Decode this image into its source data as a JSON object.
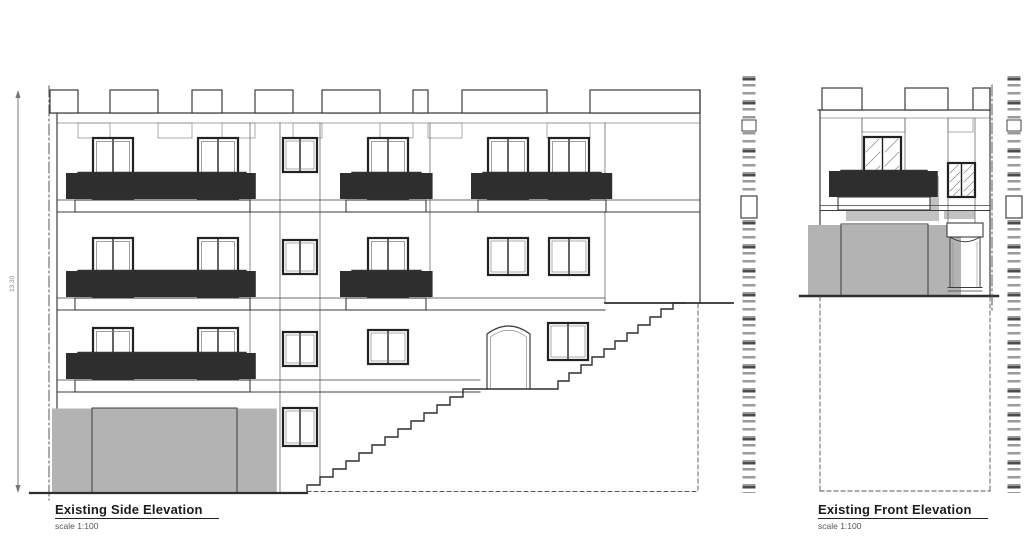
{
  "side": {
    "title": "Existing Side Elevation",
    "scale": "scale 1:100",
    "height_dimension": "13.30"
  },
  "front": {
    "title": "Existing Front Elevation",
    "scale": "scale 1:100"
  },
  "colors": {
    "line": "#3c3c3c",
    "dark_frame": "#222222",
    "shadow": "#c2c2c2",
    "garage_stripe": "#b3b3b3"
  }
}
